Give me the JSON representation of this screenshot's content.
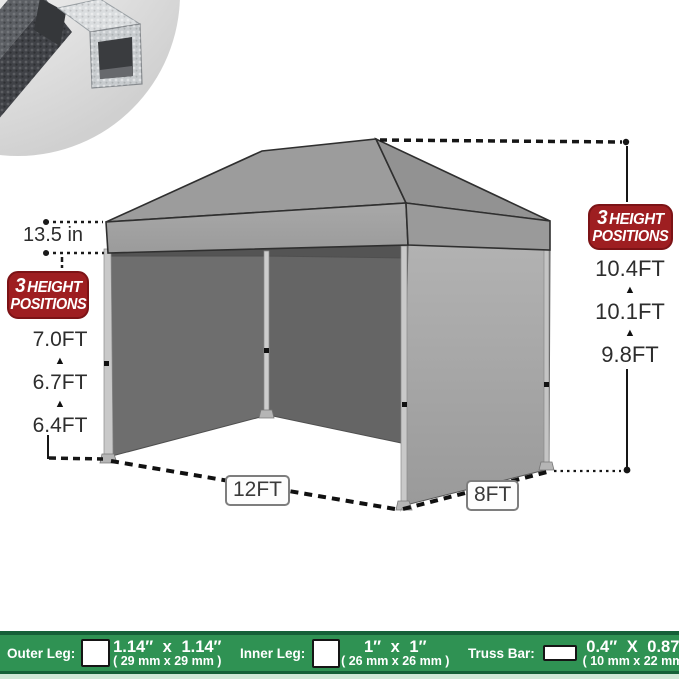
{
  "colors": {
    "badge_red": "#9e1e21",
    "bar_green": "#2f9253",
    "bar_green_dark": "#156038",
    "bar_green_pale": "#cfe7d6"
  },
  "glyphs": {
    "up_arrow": "▲"
  },
  "canopy": {
    "valance_height": "13.5 in",
    "width": "12FT",
    "depth": "8FT"
  },
  "height_badge": {
    "count": "3",
    "line1": "HEIGHT",
    "line2": "POSITIONS"
  },
  "wall_heights": {
    "top": "7.0FT",
    "mid": "6.7FT",
    "low": "6.4FT"
  },
  "peak_heights": {
    "top": "10.4FT",
    "mid": "10.1FT",
    "low": "9.8FT"
  },
  "spec_bar": {
    "outer": {
      "label": "Outer Leg:",
      "inches": "1.14″ x 1.14″",
      "mm": "( 29 mm x 29 mm )"
    },
    "inner": {
      "label": "Inner Leg:",
      "inches": "1″ x 1″",
      "mm": "( 26 mm x 26 mm )"
    },
    "truss": {
      "label": "Truss Bar:",
      "inches": "0.4″ X 0.87″",
      "mm": "( 10 mm x 22 mm )"
    }
  }
}
